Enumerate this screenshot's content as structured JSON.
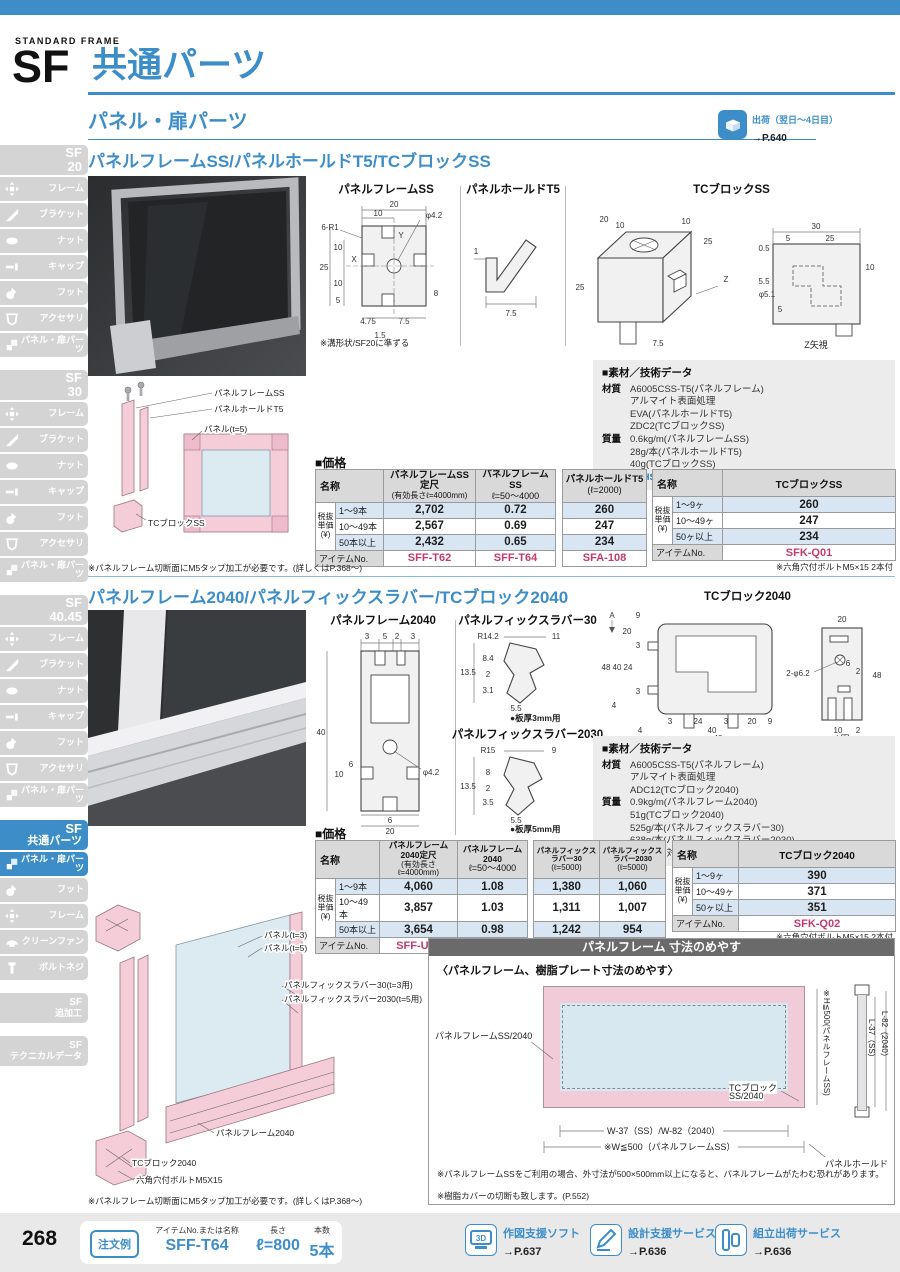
{
  "header": {
    "eyebrow": "STANDARD FRAME",
    "code": "SF",
    "title": "共通パーツ"
  },
  "section_bar": {
    "title": "パネル・扉パーツ",
    "shipping_label": "出荷（翌日～4日目）",
    "shipping_page": "→P.640"
  },
  "sidebar": {
    "groups": [
      {
        "code": "SF",
        "name": "20",
        "items": [
          {
            "label": "フレーム"
          },
          {
            "label": "ブラケット"
          },
          {
            "label": "ナット"
          },
          {
            "label": "キャップ"
          },
          {
            "label": "フット"
          },
          {
            "label": "アクセサリ"
          },
          {
            "label": "パネル・扉パーツ"
          }
        ]
      },
      {
        "code": "SF",
        "name": "30",
        "items": [
          {
            "label": "フレーム"
          },
          {
            "label": "ブラケット"
          },
          {
            "label": "ナット"
          },
          {
            "label": "キャップ"
          },
          {
            "label": "フット"
          },
          {
            "label": "アクセサリ"
          },
          {
            "label": "パネル・扉パーツ"
          }
        ]
      },
      {
        "code": "SF",
        "name": "40.45",
        "items": [
          {
            "label": "フレーム"
          },
          {
            "label": "ブラケット"
          },
          {
            "label": "ナット"
          },
          {
            "label": "キャップ"
          },
          {
            "label": "フット"
          },
          {
            "label": "アクセサリ"
          },
          {
            "label": "パネル・扉パーツ"
          }
        ]
      },
      {
        "code": "SF",
        "name": "共通パーツ",
        "items": [
          {
            "label": "パネル・扉パーツ"
          },
          {
            "label": "フット"
          },
          {
            "label": "フレーム"
          },
          {
            "label": "クリーンファン"
          },
          {
            "label": "ボルトネジ"
          }
        ]
      },
      {
        "code": "SF",
        "name": "追加工",
        "items": []
      },
      {
        "code": "SF",
        "name": "テクニカルデータ",
        "items": []
      }
    ]
  },
  "s1": {
    "title": "パネルフレームSS/パネルホールドT5/TCブロックSS",
    "d1": {
      "title": "パネルフレームSS",
      "note": "※溝形状/SF20に準ずる",
      "dims": [
        "20",
        "10",
        "6-R1",
        "φ4.2",
        "Y",
        "X",
        "25",
        "10",
        "10",
        "5",
        "8",
        "4.75",
        "7.5",
        "1.5"
      ]
    },
    "d2": {
      "title": "パネルホールドT5",
      "dims": [
        "1",
        "7.5"
      ]
    },
    "d3": {
      "title": "TCブロックSS",
      "caption": "Z矢視",
      "iso_dims": [
        "20",
        "10",
        "10",
        "25",
        "25",
        "Z",
        "7.5"
      ],
      "side_dims": [
        "30",
        "5",
        "25",
        "0.5",
        "5.5",
        "φ5.1",
        "5",
        "10"
      ]
    },
    "exploded": [
      "パネルフレームSS",
      "パネルホールドT5",
      "パネル(t=5)",
      "TCブロックSS"
    ],
    "material": {
      "title": "■素材／技術データ",
      "m_label": "材質",
      "m_lines": [
        "A6005CSS-T5(パネルフレーム)",
        "アルマイト表面処理",
        "EVA(パネルホールドT5)",
        "ZDC2(TCブロックSS)"
      ],
      "w_label": "質量",
      "w_lines": [
        "0.6kg/m(パネルフレームSS)",
        "28g/本(パネルホールドT5)",
        "40g(TCブロックSS)"
      ],
      "e_label": "環境",
      "e_hl": "RoHS10",
      "e_rest": "対応品"
    },
    "price_label": "■価格",
    "t1": {
      "name": "名称",
      "unit": [
        "税抜",
        "単価",
        "(¥)"
      ],
      "cols": [
        [
          "パネルフレームSS定尺",
          "(有効長さℓ=4000mm)"
        ],
        [
          "パネルフレームSS",
          "ℓ=50～4000"
        ],
        [
          "パネルホールドT5",
          "(ℓ=2000)"
        ]
      ],
      "rows": [
        [
          "1～9本",
          "2,702",
          "0.72",
          "260"
        ],
        [
          "10～49本",
          "2,567",
          "0.69",
          "247"
        ],
        [
          "50本以上",
          "2,432",
          "0.65",
          "234"
        ]
      ],
      "item_label": "アイテムNo.",
      "items": [
        "SFF-T62",
        "SFF-T64",
        "SFA-108"
      ]
    },
    "t2": {
      "name": "名称",
      "unit": [
        "税抜",
        "単価",
        "(¥)"
      ],
      "col": "TCブロックSS",
      "rows": [
        [
          "1～9ヶ",
          "260"
        ],
        [
          "10～49ヶ",
          "247"
        ],
        [
          "50ヶ以上",
          "234"
        ]
      ],
      "item_label": "アイテムNo.",
      "item": "SFK-Q01",
      "note": "※六角穴付ボルトM5×15 2本付"
    },
    "note": "※パネルフレーム切断面にM5タップ加工が必要です。(詳しくはP.368～)"
  },
  "s2": {
    "title": "パネルフレーム2040/パネルフィックスラバー/TCブロック2040",
    "d1": {
      "title": "パネルフレーム2040",
      "dims": [
        "3",
        "5",
        "2",
        "3",
        "40",
        "10",
        "6",
        "φ4.2",
        "6",
        "20"
      ]
    },
    "d2": {
      "title": "パネルフィックスラバー30",
      "note": "●板厚3mm用",
      "dims": [
        "R14.2",
        "11",
        "13.5",
        "8.4",
        "2",
        "3.1",
        "5.5"
      ]
    },
    "d3": {
      "title": "パネルフィックスラバー2030",
      "note": "●板厚5mm用",
      "dims": [
        "R15",
        "9",
        "13.5",
        "8",
        "2",
        "3.5",
        "5.5"
      ]
    },
    "d4": {
      "title": "TCブロック2040",
      "caption": "A図",
      "a_label": "A",
      "left_dims": [
        "9",
        "20",
        "3",
        "48",
        "40",
        "24",
        "3",
        "4",
        "3",
        "24",
        "3",
        "20",
        "9",
        "40",
        "48",
        "4"
      ],
      "right_dims": [
        "20",
        "2-φ6.2",
        "6",
        "2",
        "48",
        "10",
        "2"
      ]
    },
    "exploded": [
      "パネル(t=3)",
      "パネル(t=5)",
      "パネルフィックスラバー30(t=3用)",
      "パネルフィックスラバー2030(t=5用)",
      "パネルフレーム2040",
      "TCブロック2040",
      "六角穴付ボルトM5X15"
    ],
    "material": {
      "title": "■素材／技術データ",
      "m_label": "材質",
      "m_lines": [
        "A6005CSS-T5(パネルフレーム)",
        "アルマイト表面処理",
        "ADC12(TCブロック2040)"
      ],
      "w_label": "質量",
      "w_lines": [
        "0.9kg/m(パネルフレーム2040)",
        "51g(TCブロック2040)",
        "525g/本(パネルフィックスラバー30)",
        "638g/本(パネルフィックスラバー2030)"
      ],
      "e_label": "環境",
      "e_hl": "RoHS10",
      "e_rest": "対応品"
    },
    "price_label": "■価格",
    "t1": {
      "name": "名称",
      "unit": [
        "税抜",
        "単価",
        "(¥)"
      ],
      "cols": [
        [
          "パネルフレーム2040定尺",
          "(有効長さℓ=4000mm)"
        ],
        [
          "パネルフレーム2040",
          "ℓ=50～4000"
        ],
        [
          "パネルフィックスラバー30",
          "(ℓ=5000)"
        ],
        [
          "パネルフィックスラバー2030",
          "(ℓ=5000)"
        ]
      ],
      "rows": [
        [
          "1～9本",
          "4,060",
          "1.08",
          "1,380",
          "1,060"
        ],
        [
          "10～49本",
          "3,857",
          "1.03",
          "1,311",
          "1,007"
        ],
        [
          "50本以上",
          "3,654",
          "0.98",
          "1,242",
          "954"
        ]
      ],
      "item_label": "アイテムNo.",
      "items": [
        "SFF-U92",
        "SFF-U94",
        "SFA-142",
        "SFA-141"
      ]
    },
    "t2": {
      "name": "名称",
      "unit": [
        "税抜",
        "単価",
        "(¥)"
      ],
      "col": "TCブロック2040",
      "rows": [
        [
          "1～9ヶ",
          "390"
        ],
        [
          "10～49ヶ",
          "371"
        ],
        [
          "50ヶ以上",
          "351"
        ]
      ],
      "item_label": "アイテムNo.",
      "item": "SFK-Q02",
      "note": "※六角穴付ボルトM5×15 2本付"
    },
    "note": "※パネルフレーム切断面にM5タップ加工が必要です。(詳しくはP.368～)"
  },
  "guide": {
    "title": "パネルフレーム 寸法のめやす",
    "subtitle": "〈パネルフレーム、樹脂プレート寸法のめやす〉",
    "lbl_frame": "パネルフレームSS/2040",
    "lbl_h": "※H≦500(パネルフレームSS)",
    "lbl_tc1": "TCブロック",
    "lbl_tc2": "SS/2040",
    "lbl_l37": "L-37（SS）",
    "lbl_l82": "L-82（2040）",
    "lbl_w": "W-37（SS）/W-82（2040）",
    "lbl_wlim": "※W≦500（パネルフレームSS）",
    "lbl_hold": "パネルホールド",
    "note1": "※パネルフレームSSをご利用の場合、外寸法が500×500mm以上になると、パネルフレームがたわむ恐れがあります。",
    "note2": "※樹脂カバーの切断も致します。(P.552)"
  },
  "footer": {
    "page": "268",
    "order": "注文例",
    "badge3d": "3D",
    "f1l": "アイテムNo.または名称",
    "f1v": "SFF-T64",
    "f2l": "長さ",
    "f2v": "ℓ=800",
    "f3l": "本数",
    "f3v": "5本",
    "s1l": "作図支援ソフト",
    "s1p": "→P.637",
    "s2l": "設計支援サービス",
    "s2p": "→P.636",
    "s3l": "組立出荷サービス",
    "s3p": "→P.636"
  }
}
